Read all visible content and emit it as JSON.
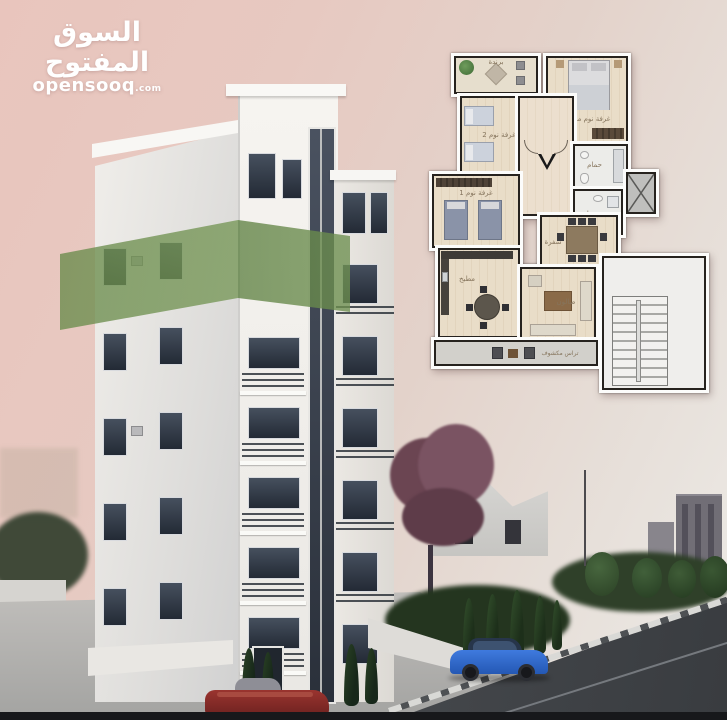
{
  "watermark": {
    "arabic": "السوق المفتوح",
    "latin": "opensooq",
    "tld": ".com"
  },
  "floor_plan": {
    "rooms": [
      {
        "id": "balcony",
        "label": "برندة"
      },
      {
        "id": "master-bedroom",
        "label": "غرفة نوم ماستر"
      },
      {
        "id": "bedroom-2",
        "label": "غرفة نوم 2"
      },
      {
        "id": "bedroom-1",
        "label": "غرفة نوم 1"
      },
      {
        "id": "bathroom-1",
        "label": "حمام"
      },
      {
        "id": "bathroom-2",
        "label": "حمام"
      },
      {
        "id": "dining",
        "label": "سفرة"
      },
      {
        "id": "kitchen",
        "label": "مطبخ"
      },
      {
        "id": "living-room",
        "label": "صالون"
      },
      {
        "id": "open-terrace",
        "label": "تراس مكشوف"
      }
    ]
  },
  "scene": {
    "colors": {
      "highlight_ribbon": "#6a8c50",
      "sky": "#e7c6bf",
      "building": "#f2f0ec",
      "road": "#42464a",
      "blue_car": "#2d64c4",
      "red_car": "#8f2f2d"
    }
  }
}
